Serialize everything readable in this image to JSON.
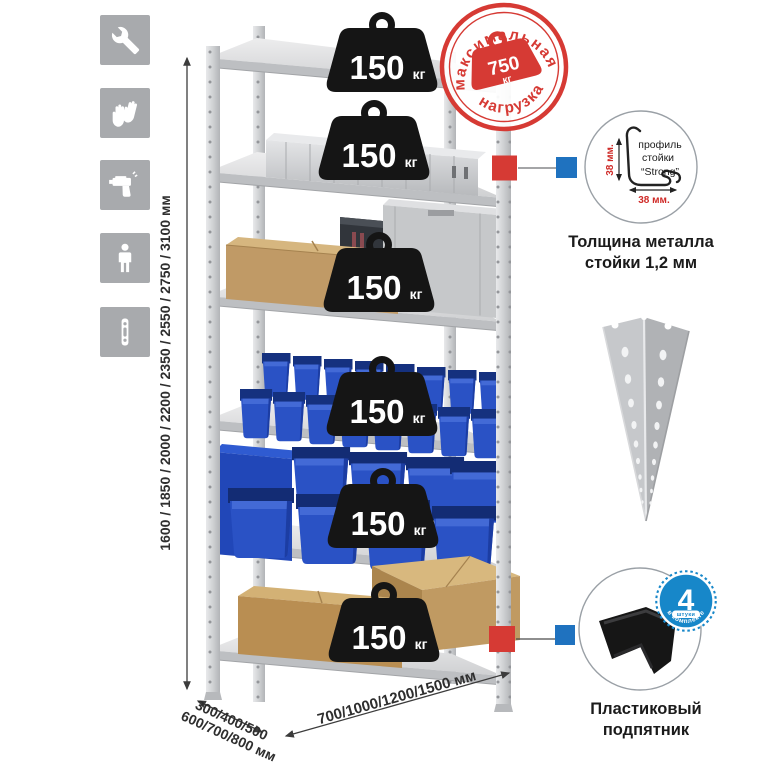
{
  "colors": {
    "accent_red": "#d63a34",
    "accent_blue": "#1f72bf",
    "badge_blue": "#1787c9",
    "bin_blue": "#2a52c5",
    "cardboard": "#c09a66",
    "metal_light": "#d9dadc",
    "weight_black": "#151515"
  },
  "assembly_icons": [
    {
      "name": "wrench-icon"
    },
    {
      "name": "gloves-icon"
    },
    {
      "name": "drill-icon"
    },
    {
      "name": "person-height-icon"
    },
    {
      "name": "post-profile-icon"
    }
  ],
  "dimensions": {
    "height_label": "1600 / 1850 / 2000 / 2200 / 2350 / 2550 / 2750 / 3100 мм",
    "depth_label_line1": "300/400/500",
    "depth_label_line2": "600/700/800 мм",
    "width_label": "700/1000/1200/1500 мм"
  },
  "max_load_stamp": {
    "arc_top": "максимальная",
    "arc_bottom": "нагрузка",
    "value": "750",
    "unit": "кг"
  },
  "rack": {
    "shelves": [
      {
        "load": "150",
        "unit": "кг"
      },
      {
        "load": "150",
        "unit": "кг"
      },
      {
        "load": "150",
        "unit": "кг"
      },
      {
        "load": "150",
        "unit": "кг"
      },
      {
        "load": "150",
        "unit": "кг"
      },
      {
        "load": "150",
        "unit": "кг"
      }
    ]
  },
  "profile_detail": {
    "label_line1": "профиль",
    "label_line2": "стойки",
    "label_line3": "“Strong”",
    "dim_vertical": "38 мм.",
    "dim_horizontal": "38 мм.",
    "caption_line1": "Толщина металла",
    "caption_line2": "стойки 1,2 мм"
  },
  "foot_detail": {
    "badge_value": "4",
    "badge_ribbon": "штуки",
    "badge_arc": "в комплекте",
    "caption_line1": "Пластиковый",
    "caption_line2": "подпятник"
  }
}
